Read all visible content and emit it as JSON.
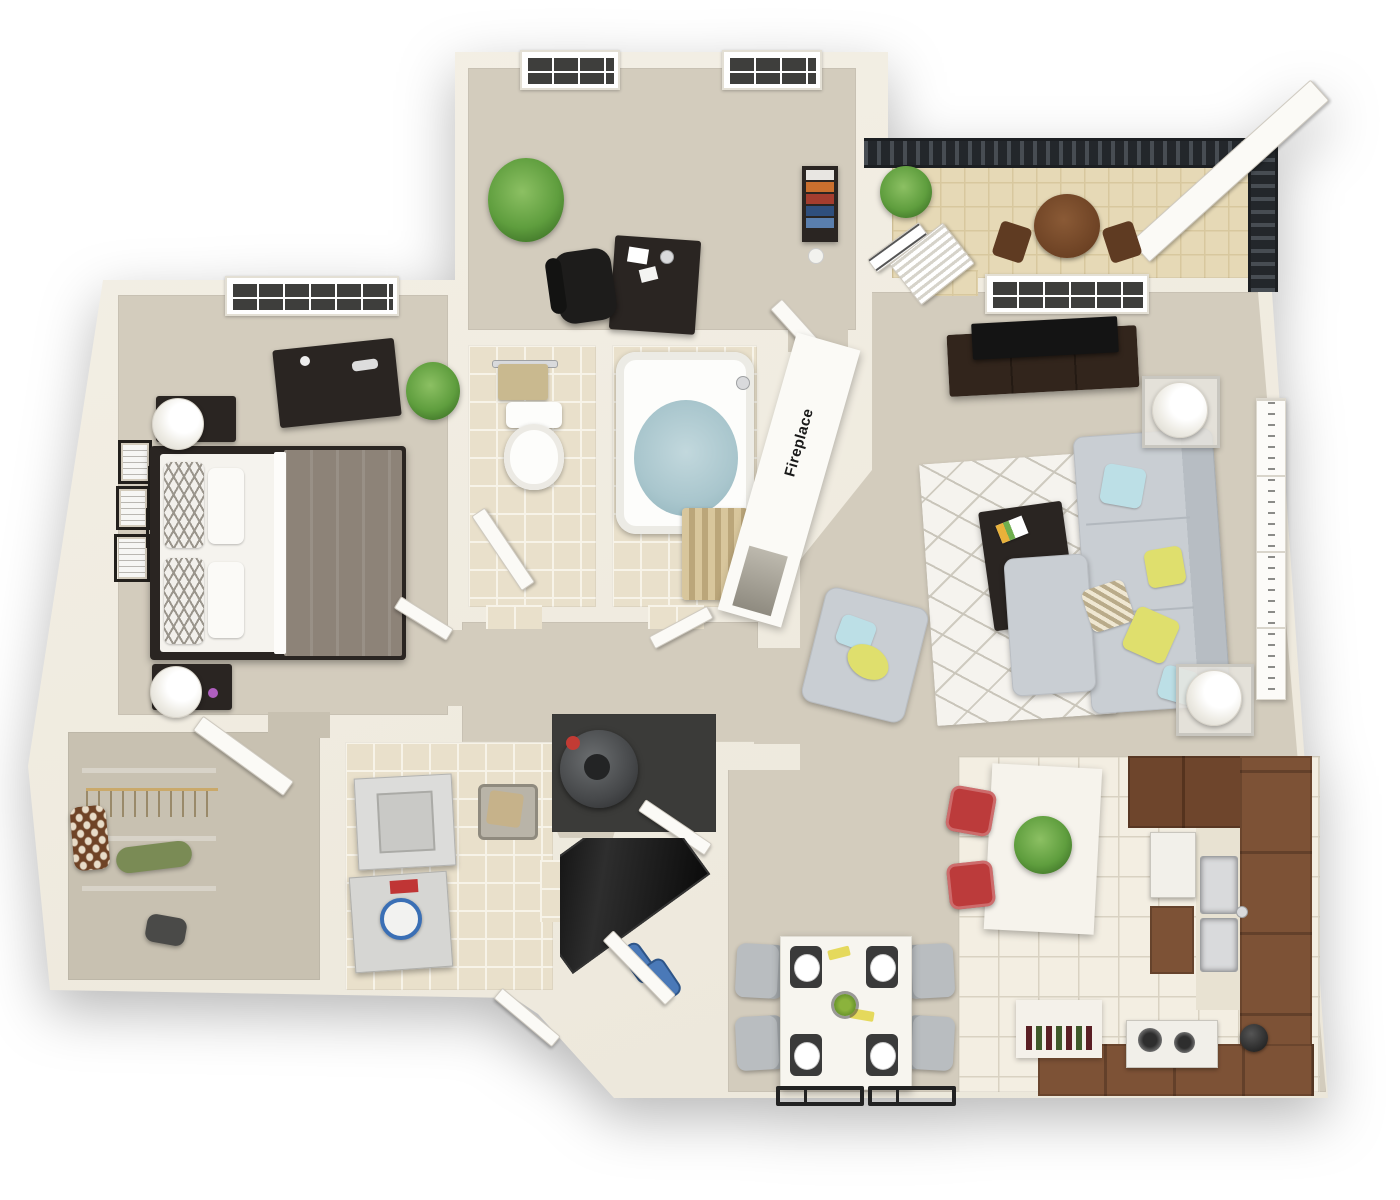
{
  "labels": {
    "fireplace": "Fireplace"
  },
  "colors": {
    "wall": "#f4f0e6",
    "wall2": "#ebe6d9",
    "carpet": "#d3ccbd",
    "carpet_dark": "#c8c1b1",
    "tile": "#e9e0cb",
    "tile_grout": "#f7f3e8",
    "tile_white": "#f3eee2",
    "tile_white_grout": "#d9d2c2",
    "balcony_tile": "#e6d9b6",
    "railing": "#23272b",
    "wood_dark": "#2a2522",
    "tv_black": "#141414",
    "counter_brown": "#7d5236",
    "cabinet_dark": "#6e452c",
    "sofa_gray": "#c9ced3",
    "pillow_yellow": "#dfdf6d",
    "pillow_blue": "#bcdfe6",
    "accent_red": "#bc3b3b",
    "plant_green": "#5f9e3e",
    "water_blue": "#a9c6cd",
    "towel_tan": "#c9b98f",
    "linen_white": "#f5f3ee",
    "blanket_taupe": "#8d8378",
    "mat_black": "#161616",
    "door_white": "#fbfaf6",
    "shoe_blue": "#4a79b8",
    "wine_red": "#5a1f24"
  },
  "rooms": [
    {
      "name": "master-bedroom",
      "floor": "carpet"
    },
    {
      "name": "office-den",
      "floor": "carpet"
    },
    {
      "name": "bathroom-toilet",
      "floor": "tile"
    },
    {
      "name": "bathroom-tub",
      "floor": "tile"
    },
    {
      "name": "hallway",
      "floor": "carpet"
    },
    {
      "name": "living-room",
      "floor": "carpet"
    },
    {
      "name": "dining-area",
      "floor": "carpet"
    },
    {
      "name": "kitchen",
      "floor": "tile"
    },
    {
      "name": "laundry-room",
      "floor": "tile"
    },
    {
      "name": "walk-in-closet",
      "floor": "carpet"
    },
    {
      "name": "entry-foyer",
      "floor": "tile"
    },
    {
      "name": "utility-closet",
      "floor": "dark"
    },
    {
      "name": "balcony",
      "floor": "tile"
    }
  ],
  "furniture": {
    "master-bedroom": [
      "double-bed",
      "nightstand",
      "nightstand",
      "table-lamp",
      "table-lamp",
      "dresser",
      "plant",
      "wall-frames",
      "window"
    ],
    "office-den": [
      "desk",
      "office-chair",
      "plant",
      "bookshelf",
      "window",
      "window",
      "door"
    ],
    "bathroom-toilet": [
      "toilet",
      "towel-bar",
      "door"
    ],
    "bathroom-tub": [
      "bathtub",
      "shower-curtain",
      "faucet"
    ],
    "living-room": [
      "tv-console",
      "tv",
      "sectional-sofa",
      "armchair",
      "rug",
      "coffee-table",
      "end-table",
      "end-table",
      "floor-lamp",
      "floor-lamp",
      "wall-art",
      "fireplace",
      "french-door",
      "louvered-door",
      "window"
    ],
    "dining-area": [
      "dining-table",
      "dining-chair",
      "dining-chair",
      "dining-chair",
      "dining-chair",
      "place-settings",
      "grate-rack",
      "grate-rack"
    ],
    "kitchen": [
      "island",
      "bar-stool",
      "bar-stool",
      "sink",
      "fridge",
      "stove",
      "counter",
      "wine-bottles",
      "kettle",
      "plant"
    ],
    "laundry-room": [
      "washer",
      "dryer",
      "laundry-basket"
    ],
    "walk-in-closet": [
      "shelves",
      "hanging-clothes",
      "duffel-bag",
      "bag",
      "door"
    ],
    "entry-foyer": [
      "doormat",
      "shoes"
    ],
    "utility-closet": [
      "water-heater"
    ],
    "balcony": [
      "railing",
      "round-table",
      "patio-chair",
      "patio-chair",
      "plant"
    ]
  }
}
